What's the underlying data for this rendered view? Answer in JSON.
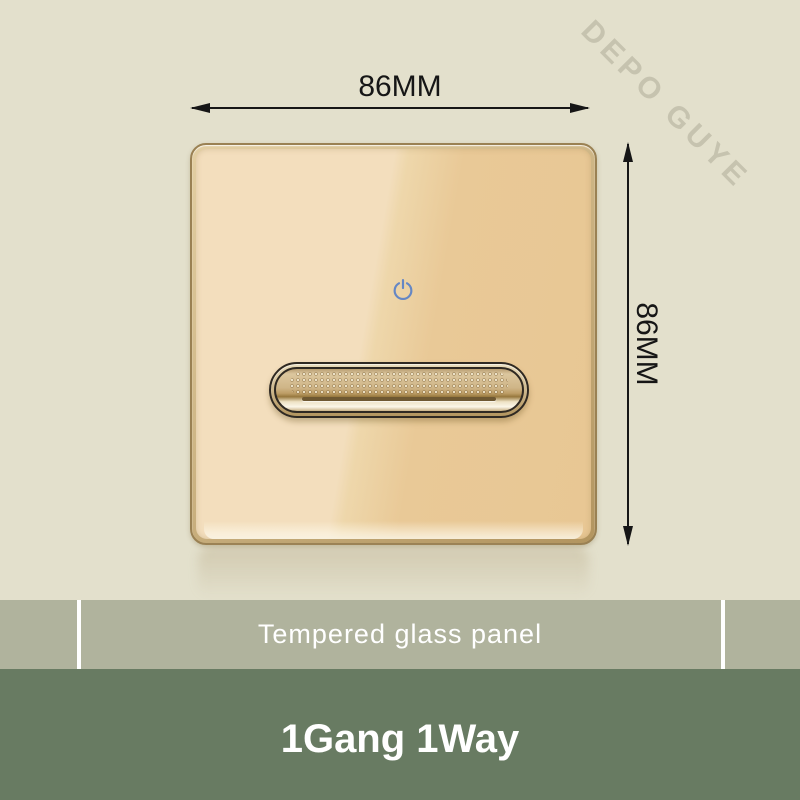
{
  "watermark": {
    "text": "DEPO GUYE"
  },
  "dimensions": {
    "width_label": "86MM",
    "height_label": "86MM"
  },
  "switch_panel": {
    "description": "gold tempered glass 1 gang touch-style switch panel with metallic rocker button",
    "icons": {
      "power": "power-icon",
      "width_arrows": [
        "arrow-left-icon",
        "arrow-right-icon"
      ],
      "height_arrows": [
        "arrow-up-icon",
        "arrow-down-icon"
      ]
    }
  },
  "spec_banner": {
    "label": "Tempered glass panel"
  },
  "product_banner": {
    "label": "1Gang 1Way"
  },
  "colors": {
    "background": "#e3e0cc",
    "glass_light": "#f3debd",
    "glass_dark": "#e9c997",
    "power_icon_blue": "#6587c4",
    "sage_band": "#b0b39d",
    "dark_green_band": "#687b62",
    "text_dark": "#161616",
    "text_white": "#ffffff"
  }
}
